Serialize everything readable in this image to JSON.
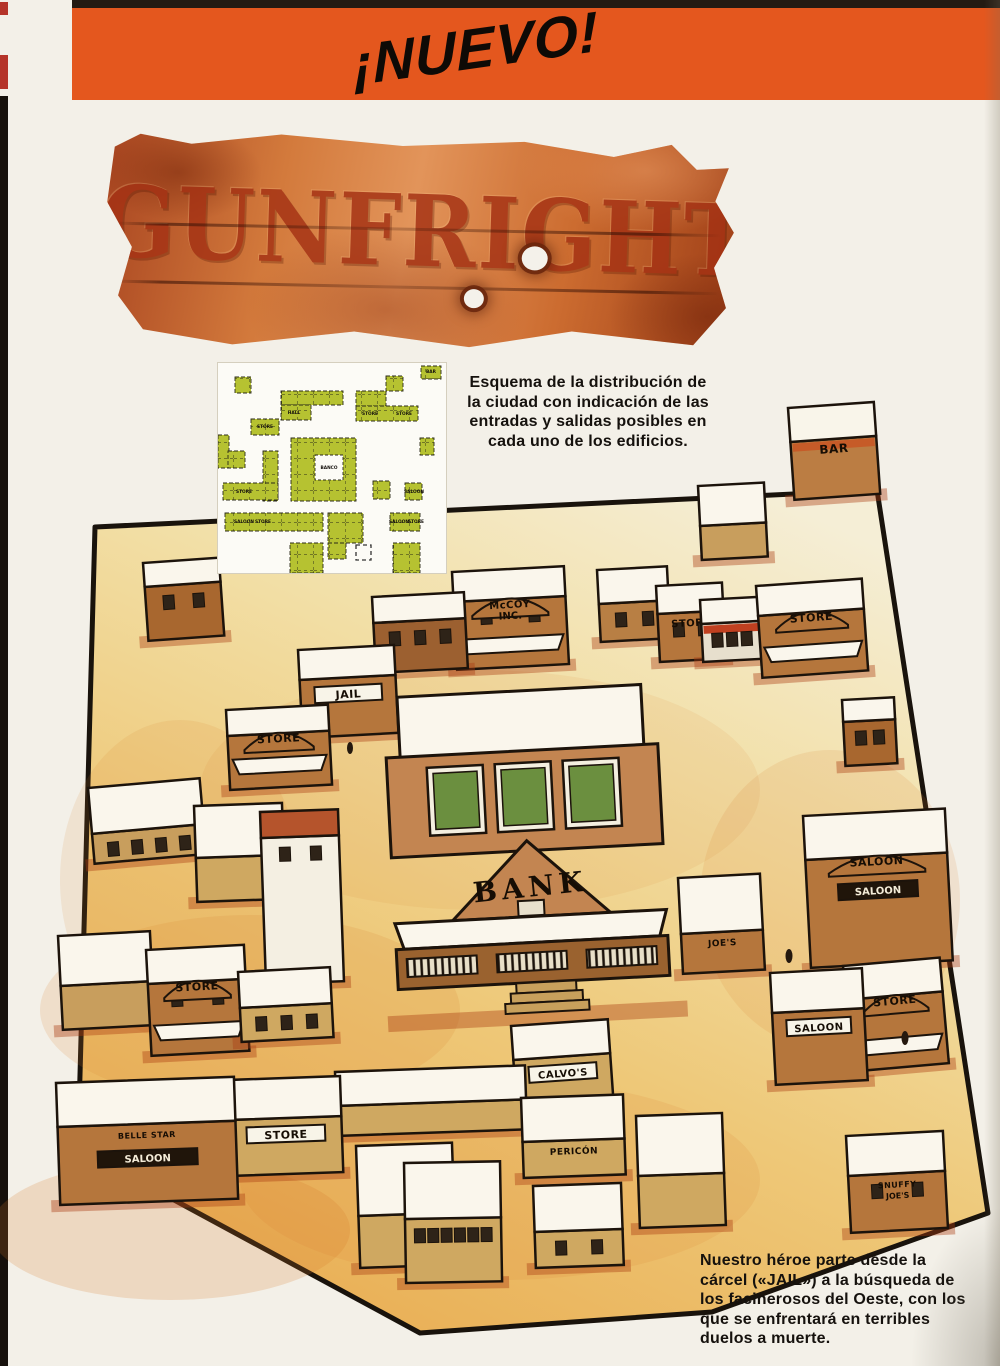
{
  "banner": {
    "text": "¡NUEVO!",
    "color": "#e4571e"
  },
  "logo": {
    "title": "GUNFRIGHT"
  },
  "intro": {
    "text": "Esquema de la distribución de\nla ciudad con indicación de las\nentradas y salidas posibles en\ncada uno de los edificios."
  },
  "footer": {
    "text": "Nuestro héroe parte desde la\ncárcel («JAIL») a la búsqueda de\nlos facinerosos del Oeste, con los\nque se enfrentará en terribles\nduelos a muerte."
  },
  "minimap": {
    "panel": {
      "w": 228,
      "h": 210
    },
    "block_color": "#b6c231",
    "blocks": [
      [
        203,
        3,
        20,
        13
      ],
      [
        17,
        14,
        16,
        16
      ],
      [
        63,
        28,
        62,
        14
      ],
      [
        63,
        42,
        30,
        15
      ],
      [
        168,
        13,
        17,
        15
      ],
      [
        138,
        28,
        30,
        15
      ],
      [
        138,
        43,
        62,
        15
      ],
      [
        33,
        56,
        28,
        16
      ],
      [
        0,
        72,
        11,
        33
      ],
      [
        10,
        88,
        17,
        17
      ],
      [
        45,
        88,
        15,
        50
      ],
      [
        73,
        75,
        65,
        63
      ],
      [
        202,
        75,
        14,
        17
      ],
      [
        5,
        120,
        55,
        17
      ],
      [
        155,
        118,
        17,
        18
      ],
      [
        187,
        120,
        17,
        17
      ],
      [
        7,
        150,
        98,
        18
      ],
      [
        110,
        150,
        35,
        30
      ],
      [
        172,
        150,
        30,
        18
      ],
      [
        72,
        180,
        33,
        30
      ],
      [
        175,
        180,
        27,
        30
      ],
      [
        110,
        180,
        18,
        16
      ]
    ],
    "hole": [
      97,
      92,
      28,
      25
    ],
    "marker": [
      138,
      182,
      15,
      15
    ],
    "labels": [
      [
        213,
        10,
        "BAR"
      ],
      [
        76,
        51,
        "HALL"
      ],
      [
        47,
        65,
        "STORE"
      ],
      [
        152,
        52,
        "STORE"
      ],
      [
        186,
        52,
        "STORE"
      ],
      [
        111,
        106,
        "BANCO"
      ],
      [
        26,
        130,
        "STORE"
      ],
      [
        196,
        130,
        "SALOON"
      ],
      [
        26,
        160,
        "SALOON"
      ],
      [
        45,
        160,
        "STORE"
      ],
      [
        181,
        160,
        "SALOON"
      ],
      [
        198,
        160,
        "STORE"
      ]
    ]
  },
  "map": {
    "outline": "95,527 877,490 988,1213 712,1312 420,1333 78,1148",
    "sand_colors": [
      "#f5eed6",
      "#f2dfa6",
      "#eec878",
      "#e9ae54"
    ],
    "buildings": [
      {
        "x": 788,
        "y": 408,
        "w": 86,
        "h": 92,
        "rot": -4,
        "roofH": 34,
        "col": "#bb7d43",
        "roof": "#f9f5ea",
        "band": "#c65b28",
        "label": "BAR",
        "fs": 12
      },
      {
        "x": 698,
        "y": 486,
        "w": 66,
        "h": 74,
        "rot": -3,
        "roofH": 40,
        "col": "#c89e5d"
      },
      {
        "x": 143,
        "y": 563,
        "w": 76,
        "h": 78,
        "rot": -4,
        "roofH": 24,
        "col": "#a8672f",
        "win": 2
      },
      {
        "x": 597,
        "y": 570,
        "w": 70,
        "h": 72,
        "rot": -3,
        "roofH": 34,
        "col": "#b87f44",
        "win": 2
      },
      {
        "x": 452,
        "y": 572,
        "w": 112,
        "h": 98,
        "rot": -3,
        "roofH": 30,
        "col": "#b5763c",
        "awn": true,
        "arch": true,
        "label": "McCOY",
        "label2": "INC.",
        "fs": 10,
        "win": 2
      },
      {
        "x": 656,
        "y": 586,
        "w": 66,
        "h": 76,
        "rot": -3,
        "roofH": 28,
        "col": "#b5763c",
        "label": "STORE",
        "fs": 10,
        "win": 2
      },
      {
        "x": 372,
        "y": 597,
        "w": 92,
        "h": 76,
        "rot": -3,
        "roofH": 26,
        "col": "#9c6030",
        "win": 3
      },
      {
        "x": 700,
        "y": 600,
        "w": 60,
        "h": 62,
        "rot": -3,
        "roofH": 24,
        "col": "#e7dfcd",
        "band": "#c04020",
        "win": 3
      },
      {
        "x": 756,
        "y": 586,
        "w": 106,
        "h": 92,
        "rot": -4,
        "roofH": 30,
        "col": "#b5763c",
        "awn": true,
        "arch": true,
        "label": "STORE",
        "fs": 11
      },
      {
        "x": 298,
        "y": 650,
        "w": 96,
        "h": 88,
        "rot": -3,
        "roofH": 30,
        "col": "#b5763c",
        "sign": true,
        "label": "JAIL",
        "fs": 11
      },
      {
        "x": 383,
        "y": 698,
        "type": "bank",
        "w": 272,
        "h": 330,
        "rot": -3,
        "col": "#c38551",
        "label": "BANK"
      },
      {
        "x": 842,
        "y": 700,
        "w": 52,
        "h": 66,
        "rot": -3,
        "roofH": 22,
        "col": "#a8672f",
        "win": 2
      },
      {
        "x": 226,
        "y": 710,
        "w": 102,
        "h": 80,
        "rot": -3,
        "roofH": 26,
        "col": "#b5763c",
        "awn": true,
        "arch": true,
        "label": "STORE",
        "fs": 11
      },
      {
        "x": 88,
        "y": 788,
        "w": 112,
        "h": 76,
        "rot": -5,
        "roofH": 46,
        "col": "#c89e5d",
        "win": 4
      },
      {
        "x": 194,
        "y": 806,
        "w": 88,
        "h": 96,
        "rot": -2,
        "roofH": 52,
        "col": "#cfa861"
      },
      {
        "x": 260,
        "y": 812,
        "w": 78,
        "h": 172,
        "rot": -2,
        "roofH": 26,
        "col": "#f4efe2",
        "roof": "#b5542c",
        "win": 2
      },
      {
        "x": 803,
        "y": 816,
        "w": 142,
        "h": 152,
        "rot": -3,
        "roofH": 44,
        "col": "#b5763c",
        "arch": true,
        "label": "SALOON",
        "sign2": "SALOON",
        "fs": 11
      },
      {
        "x": 678,
        "y": 878,
        "w": 82,
        "h": 96,
        "rot": -3,
        "roofH": 56,
        "col": "#b5763c",
        "label": "JOE'S",
        "fs": 9
      },
      {
        "x": 58,
        "y": 936,
        "w": 92,
        "h": 94,
        "rot": -3,
        "roofH": 50,
        "col": "#c89e5d"
      },
      {
        "x": 146,
        "y": 950,
        "w": 98,
        "h": 106,
        "rot": -3,
        "roofH": 34,
        "col": "#b5763c",
        "awn": true,
        "arch": true,
        "label": "STORE",
        "fs": 11,
        "win": 2
      },
      {
        "x": 843,
        "y": 966,
        "w": 97,
        "h": 106,
        "rot": -5,
        "roofH": 34,
        "col": "#b5763c",
        "awn": true,
        "arch": true,
        "label": "STORE",
        "fs": 11
      },
      {
        "x": 238,
        "y": 972,
        "w": 92,
        "h": 70,
        "rot": -3,
        "roofH": 36,
        "col": "#cfa861",
        "win": 3
      },
      {
        "x": 770,
        "y": 973,
        "w": 92,
        "h": 112,
        "rot": -3,
        "roofH": 40,
        "col": "#b5763c",
        "sign": true,
        "label": "SALOON",
        "fs": 10
      },
      {
        "x": 511,
        "y": 1026,
        "w": 97,
        "h": 92,
        "rot": -4,
        "roofH": 34,
        "col": "#cfa861",
        "sign": true,
        "label": "CALVO'S",
        "fs": 10
      },
      {
        "x": 335,
        "y": 1072,
        "w": 190,
        "h": 64,
        "rot": -2,
        "roofH": 34,
        "col": "#cfa861"
      },
      {
        "x": 228,
        "y": 1080,
        "w": 112,
        "h": 96,
        "rot": -2,
        "roofH": 40,
        "col": "#cfa861",
        "sign": true,
        "label": "STORE",
        "fs": 11
      },
      {
        "x": 56,
        "y": 1083,
        "w": 178,
        "h": 122,
        "rot": -2,
        "roofH": 44,
        "col": "#b5763c",
        "label": "BELLE STAR",
        "fs": 8,
        "sign2": "SALOON"
      },
      {
        "x": 521,
        "y": 1098,
        "w": 102,
        "h": 80,
        "rot": -2,
        "roofH": 44,
        "col": "#cfa861",
        "label": "PERICÓN",
        "fs": 9
      },
      {
        "x": 636,
        "y": 1116,
        "w": 86,
        "h": 112,
        "rot": -2,
        "roofH": 60,
        "col": "#cfa861"
      },
      {
        "x": 846,
        "y": 1136,
        "w": 97,
        "h": 97,
        "rot": -3,
        "roofH": 40,
        "col": "#b5763c",
        "label": "SNUFFY",
        "label2": "JOE'S",
        "fs": 8,
        "win": 2
      },
      {
        "x": 356,
        "y": 1146,
        "w": 96,
        "h": 122,
        "rot": -2,
        "roofH": 70,
        "col": "#cfa861"
      },
      {
        "x": 404,
        "y": 1163,
        "w": 96,
        "h": 120,
        "rot": -1,
        "roofH": 56,
        "col": "#cfa861",
        "win": 6
      },
      {
        "x": 533,
        "y": 1186,
        "w": 88,
        "h": 82,
        "rot": -2,
        "roofH": 46,
        "col": "#cfa861",
        "win": 2
      }
    ]
  }
}
